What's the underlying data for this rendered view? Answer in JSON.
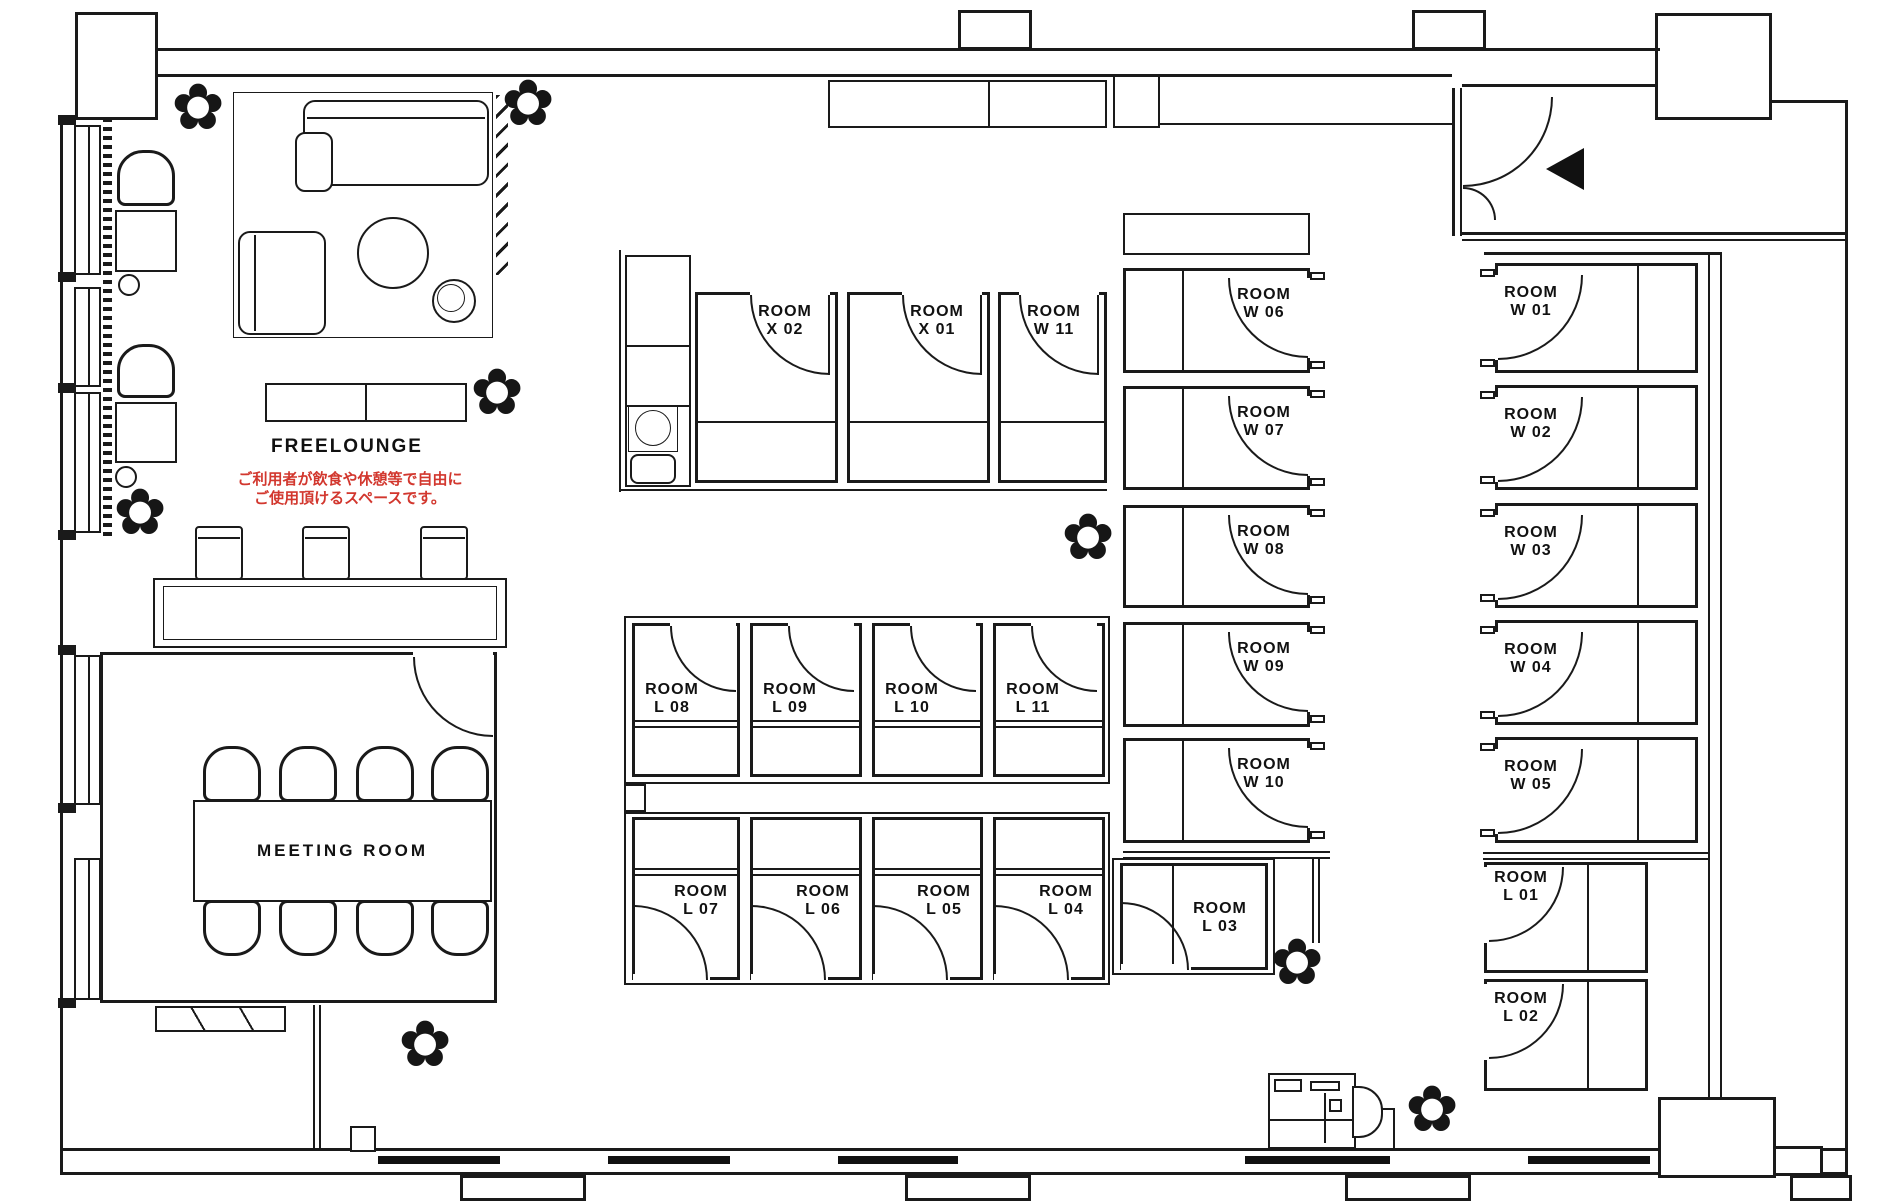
{
  "palette": {
    "line": "#1a1a1a",
    "background": "#ffffff",
    "note_red": "#d2372e"
  },
  "lounge": {
    "label": "FREELOUNGE",
    "note_line1": "ご利用者が飲食や休憩等で自由に",
    "note_line2": "ご使用頂けるスペースです。"
  },
  "meeting_room": {
    "label": "MEETING ROOM"
  },
  "rooms": {
    "x02": {
      "line1": "ROOM",
      "line2": "X 02"
    },
    "x01": {
      "line1": "ROOM",
      "line2": "X 01"
    },
    "w11": {
      "line1": "ROOM",
      "line2": "W 11"
    },
    "w06": {
      "line1": "ROOM",
      "line2": "W 06"
    },
    "w07": {
      "line1": "ROOM",
      "line2": "W 07"
    },
    "w08": {
      "line1": "ROOM",
      "line2": "W 08"
    },
    "w09": {
      "line1": "ROOM",
      "line2": "W 09"
    },
    "w10": {
      "line1": "ROOM",
      "line2": "W 10"
    },
    "w01": {
      "line1": "ROOM",
      "line2": "W 01"
    },
    "w02": {
      "line1": "ROOM",
      "line2": "W 02"
    },
    "w03": {
      "line1": "ROOM",
      "line2": "W 03"
    },
    "w04": {
      "line1": "ROOM",
      "line2": "W 04"
    },
    "w05": {
      "line1": "ROOM",
      "line2": "W 05"
    },
    "l01": {
      "line1": "ROOM",
      "line2": "L 01"
    },
    "l02": {
      "line1": "ROOM",
      "line2": "L 02"
    },
    "l03": {
      "line1": "ROOM",
      "line2": "L 03"
    },
    "l04": {
      "line1": "ROOM",
      "line2": "L 04"
    },
    "l05": {
      "line1": "ROOM",
      "line2": "L 05"
    },
    "l06": {
      "line1": "ROOM",
      "line2": "L 06"
    },
    "l07": {
      "line1": "ROOM",
      "line2": "L 07"
    },
    "l08": {
      "line1": "ROOM",
      "line2": "L 08"
    },
    "l09": {
      "line1": "ROOM",
      "line2": "L 09"
    },
    "l10": {
      "line1": "ROOM",
      "line2": "L 10"
    },
    "l11": {
      "line1": "ROOM",
      "line2": "L 11"
    }
  },
  "glyphs": {
    "plant": "✿"
  }
}
